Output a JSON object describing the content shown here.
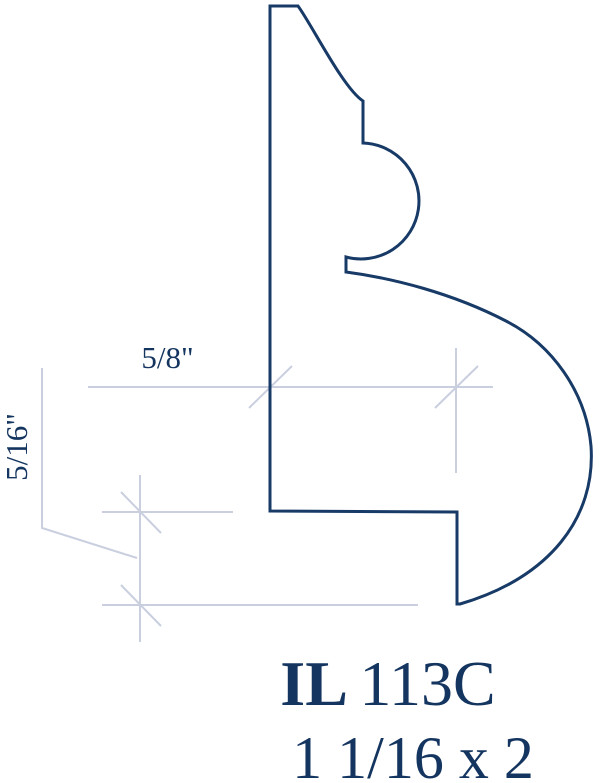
{
  "drawing": {
    "type": "molding-profile-cross-section",
    "outline_color": "#173a67",
    "dimension_color": "#c9cfdf",
    "text_color": "#14355f",
    "background_color": "#ffffff"
  },
  "labels": {
    "width_dimension": "5/8\"",
    "height_dimension": "5/16\"",
    "code_prefix": "IL",
    "code_number": "113C",
    "size": "1 1/16 x 2"
  }
}
